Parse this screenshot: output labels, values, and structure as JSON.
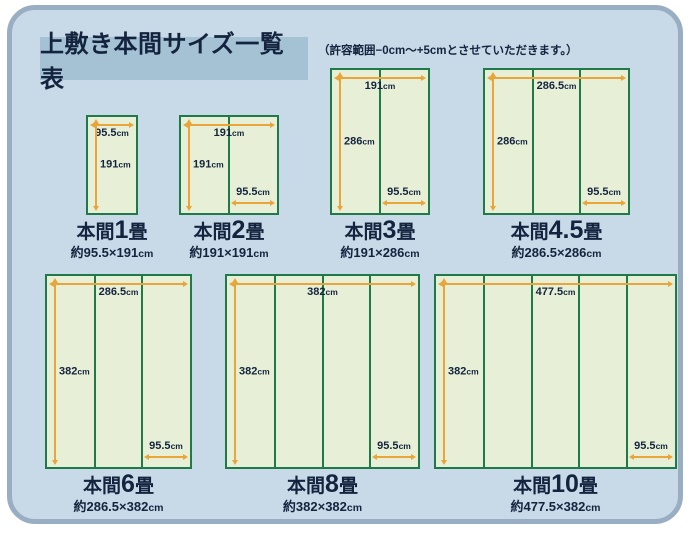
{
  "page": {
    "title": "上敷き本間サイズ一覧表",
    "note": "（許容範囲−0cm〜+5cmとさせていただきます。）"
  },
  "colors": {
    "page_background": "#ffffff",
    "panel_background": "#c8d9e8",
    "panel_border": "#9aaec3",
    "title_background": "#a5c2d5",
    "text": "#14243e",
    "mat_fill": "#e7f0d6",
    "mat_border": "#1e7a48",
    "dimension_line": "#e9a53a"
  },
  "scale_px_per_cm": 0.5,
  "diagrams": [
    {
      "id": "honma-1jo",
      "name_prefix": "本間",
      "name_number": "1",
      "name_suffix": "畳",
      "size_label": "約95.5×191cm",
      "width_cm": 95.5,
      "height_cm": 191,
      "panels": 1,
      "top_label": "95.5cm",
      "left_label": "191cm",
      "panel_label": null
    },
    {
      "id": "honma-2jo",
      "name_prefix": "本間",
      "name_number": "2",
      "name_suffix": "畳",
      "size_label": "約191×191cm",
      "width_cm": 191,
      "height_cm": 191,
      "panels": 2,
      "top_label": "191cm",
      "left_label": "191cm",
      "panel_label": "95.5cm"
    },
    {
      "id": "honma-3jo",
      "name_prefix": "本間",
      "name_number": "3",
      "name_suffix": "畳",
      "size_label": "約191×286cm",
      "width_cm": 191,
      "height_cm": 286,
      "panels": 2,
      "top_label": "191cm",
      "left_label": "286cm",
      "panel_label": "95.5cm"
    },
    {
      "id": "honma-4-5jo",
      "name_prefix": "本間",
      "name_number": "4.5",
      "name_suffix": "畳",
      "size_label": "約286.5×286cm",
      "width_cm": 286.5,
      "height_cm": 286,
      "panels": 3,
      "top_label": "286.5cm",
      "left_label": "286cm",
      "panel_label": "95.5cm"
    },
    {
      "id": "honma-6jo",
      "name_prefix": "本間",
      "name_number": "6",
      "name_suffix": "畳",
      "size_label": "約286.5×382cm",
      "width_cm": 286.5,
      "height_cm": 382,
      "panels": 3,
      "top_label": "286.5cm",
      "left_label": "382cm",
      "panel_label": "95.5cm"
    },
    {
      "id": "honma-8jo",
      "name_prefix": "本間",
      "name_number": "8",
      "name_suffix": "畳",
      "size_label": "約382×382cm",
      "width_cm": 382,
      "height_cm": 382,
      "panels": 4,
      "top_label": "382cm",
      "left_label": "382cm",
      "panel_label": "95.5cm"
    },
    {
      "id": "honma-10jo",
      "name_prefix": "本間",
      "name_number": "10",
      "name_suffix": "畳",
      "size_label": "約477.5×382cm",
      "width_cm": 477.5,
      "height_cm": 382,
      "panels": 5,
      "top_label": "477.5cm",
      "left_label": "382cm",
      "panel_label": "95.5cm"
    }
  ]
}
